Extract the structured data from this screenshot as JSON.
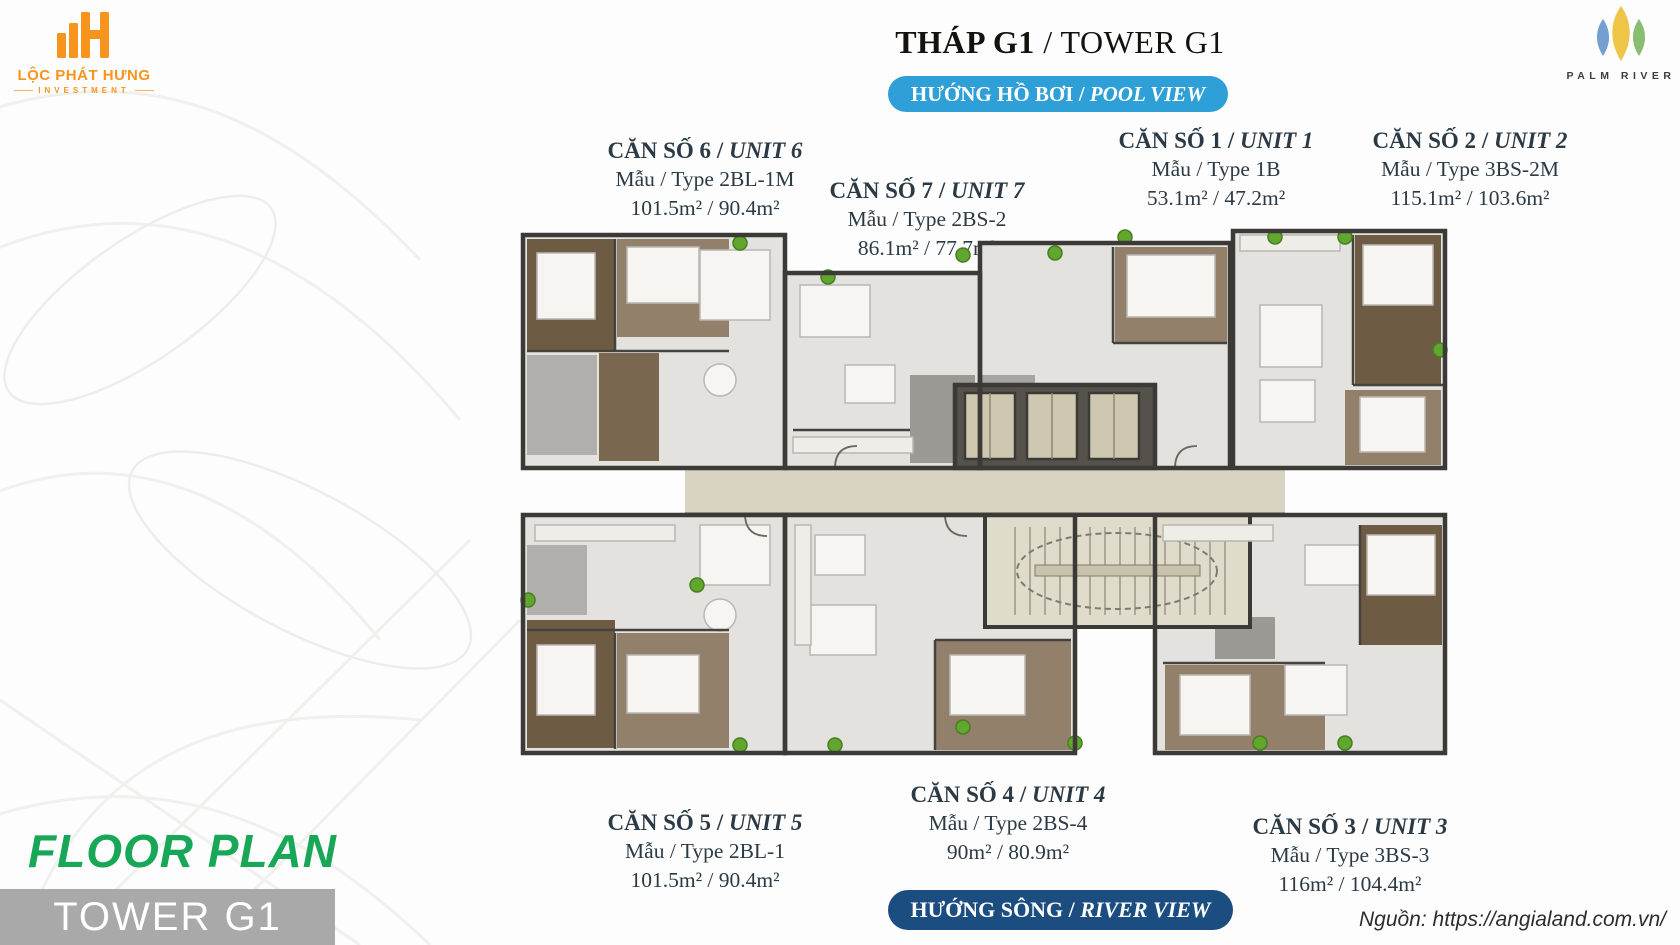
{
  "sep": " / ",
  "branding": {
    "loc_phat_hung": {
      "name": "LỘC PHÁT HƯNG",
      "subtitle": "INVESTMENT",
      "accent": "#f7941d"
    },
    "palm_river": {
      "name": "PALM RIVER",
      "leaf_colors": [
        "#5b8fc9",
        "#edc23c",
        "#74b259"
      ]
    }
  },
  "header": {
    "title_vi": "THÁP G1",
    "title_en": "TOWER G1"
  },
  "badges": {
    "pool": {
      "label_vi": "HƯỚNG HỒ BƠI",
      "label_en": "POOL VIEW",
      "bg": "#2f9fd8"
    },
    "river": {
      "label_vi": "HƯỚNG SÔNG",
      "label_en": "RIVER VIEW",
      "bg": "#1c4d80"
    }
  },
  "units": [
    {
      "name_vi": "CĂN SỐ 6",
      "name_en": "UNIT 6",
      "type_line": "Mẫu / Type 2BL-1M",
      "area_line": "101.5m² / 90.4m²"
    },
    {
      "name_vi": "CĂN SỐ 7",
      "name_en": "UNIT 7",
      "type_line": "Mẫu / Type 2BS-2",
      "area_line": "86.1m² / 77.7m²"
    },
    {
      "name_vi": "CĂN SỐ 1",
      "name_en": "UNIT 1",
      "type_line": "Mẫu / Type 1B",
      "area_line": "53.1m² / 47.2m²"
    },
    {
      "name_vi": "CĂN SỐ 2",
      "name_en": "UNIT 2",
      "type_line": "Mẫu / Type 3BS-2M",
      "area_line": "115.1m² / 103.6m²"
    },
    {
      "name_vi": "CĂN SỐ 5",
      "name_en": "UNIT 5",
      "type_line": "Mẫu / Type 2BL-1",
      "area_line": "101.5m² / 90.4m²"
    },
    {
      "name_vi": "CĂN SỐ 4",
      "name_en": "UNIT 4",
      "type_line": "Mẫu / Type 2BS-4",
      "area_line": "90m² / 80.9m²"
    },
    {
      "name_vi": "CĂN SỐ 3",
      "name_en": "UNIT 3",
      "type_line": "Mẫu / Type 3BS-3",
      "area_line": "116m² / 104.4m²"
    }
  ],
  "footer": {
    "floor_plan_label": "FLOOR PLAN",
    "tower_label": "TOWER G1",
    "source": "Nguồn: https://angialand.com.vn/",
    "green": "#17a757",
    "box_gray": "#a9a9a9"
  }
}
